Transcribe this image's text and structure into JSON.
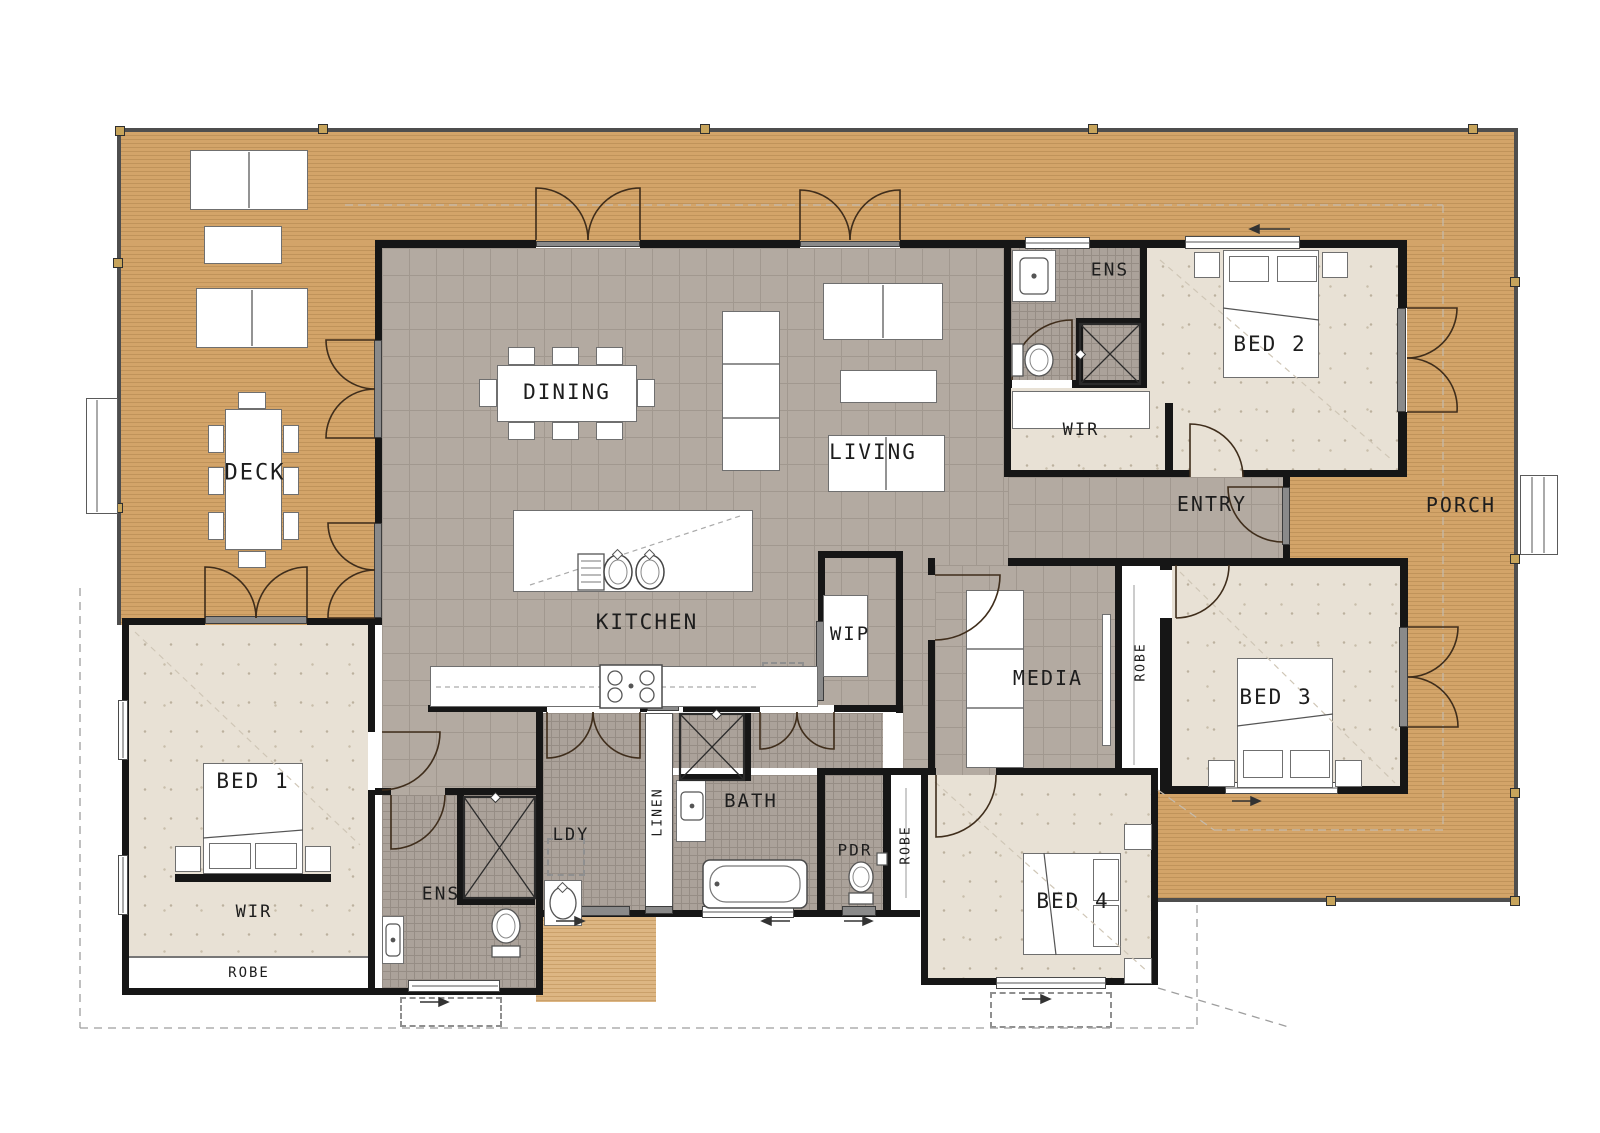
{
  "document": {
    "type": "architectural floor plan",
    "storey": "ground floor"
  },
  "rooms": {
    "deck": {
      "label": "DECK",
      "floor": "timber deck"
    },
    "dining": {
      "label": "DINING",
      "floor": "tile"
    },
    "living": {
      "label": "LIVING",
      "floor": "tile"
    },
    "kitchen": {
      "label": "KITCHEN",
      "floor": "tile"
    },
    "wip": {
      "label": "WIP",
      "floor": "tile"
    },
    "entry": {
      "label": "ENTRY",
      "floor": "tile"
    },
    "porch": {
      "label": "PORCH",
      "floor": "timber deck"
    },
    "media": {
      "label": "MEDIA",
      "floor": "tile"
    },
    "bed1": {
      "label": "BED 1",
      "floor": "carpet"
    },
    "bed2": {
      "label": "BED 2",
      "floor": "carpet"
    },
    "bed3": {
      "label": "BED 3",
      "floor": "carpet"
    },
    "bed4": {
      "label": "BED 4",
      "floor": "carpet"
    },
    "ens_bed2": {
      "label": "ENS",
      "floor": "wet tile"
    },
    "ens_master": {
      "label": "ENS",
      "floor": "wet tile"
    },
    "wir_bed2": {
      "label": "WIR",
      "floor": "carpet"
    },
    "wir_master": {
      "label": "WIR",
      "floor": "carpet"
    },
    "ldy": {
      "label": "LDY",
      "floor": "wet tile"
    },
    "linen": {
      "label": "LINEN"
    },
    "bath": {
      "label": "BATH",
      "floor": "wet tile"
    },
    "pdr": {
      "label": "PDR",
      "floor": "wet tile"
    },
    "robe_bed1": {
      "label": "ROBE"
    },
    "robe_bed3": {
      "label": "ROBE"
    },
    "robe_bed4": {
      "label": "ROBE"
    }
  },
  "colors": {
    "deck_timber": "#d3a469",
    "landing_timber": "#ddb683",
    "tile": "#b3aaa1",
    "wet_tile": "#aba29a",
    "carpet": "#e8e1d5",
    "wall": "#161616"
  }
}
